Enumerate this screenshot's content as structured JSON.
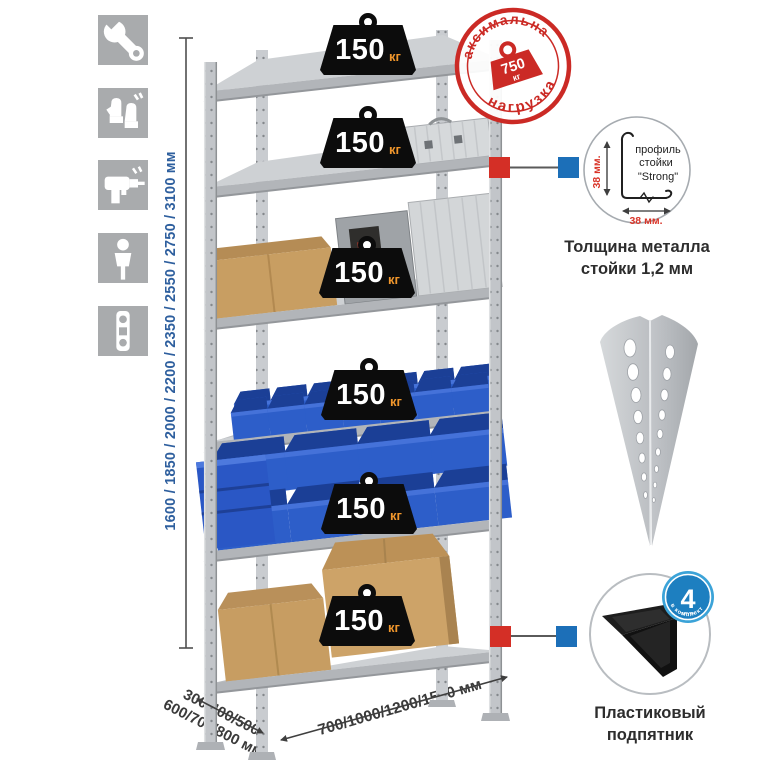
{
  "colors": {
    "accent_blue": "#2e5f9e",
    "stamp_red": "#cb2a25",
    "marker_red": "#d42f26",
    "marker_blue": "#1c6fb8",
    "badge_blue": "#1d7fc0",
    "weight_unit_orange": "#f0962c",
    "bin_blue": "#2d5ec9",
    "icon_tile_gray": "#a9abad"
  },
  "sidebar_icons": [
    "wrench-icon",
    "gloves-icon",
    "drill-icon",
    "person-icon",
    "level-icon"
  ],
  "dimensions": {
    "height": "1600 / 1850 / 2000 / 2200 / 2350 / 2550 / 2750 / 3100 мм",
    "depth_line1": "300/400/500",
    "depth_line2": "600/700/800 мм",
    "width": "700/1000/1200/1500 мм"
  },
  "shelf_weights": [
    {
      "value": "150",
      "unit": "кг"
    },
    {
      "value": "150",
      "unit": "кг"
    },
    {
      "value": "150",
      "unit": "кг"
    },
    {
      "value": "150",
      "unit": "кг"
    },
    {
      "value": "150",
      "unit": "кг"
    },
    {
      "value": "150",
      "unit": "кг"
    }
  ],
  "max_load_stamp": {
    "arc_top": "максимальная",
    "arc_bottom": "нагрузка",
    "value": "750",
    "unit": "кг"
  },
  "profile_detail": {
    "line1": "профиль",
    "line2": "стойки",
    "line3": "\"Strong\"",
    "dim_vertical": "38 мм.",
    "dim_horizontal": "38 мм.",
    "caption1": "Толщина металла",
    "caption2": "стойки 1,2 мм"
  },
  "foot_detail": {
    "badge_value": "4",
    "badge_sub": "штуки",
    "badge_arc": "в комплекте",
    "caption1": "Пластиковый",
    "caption2": "подпятник"
  }
}
